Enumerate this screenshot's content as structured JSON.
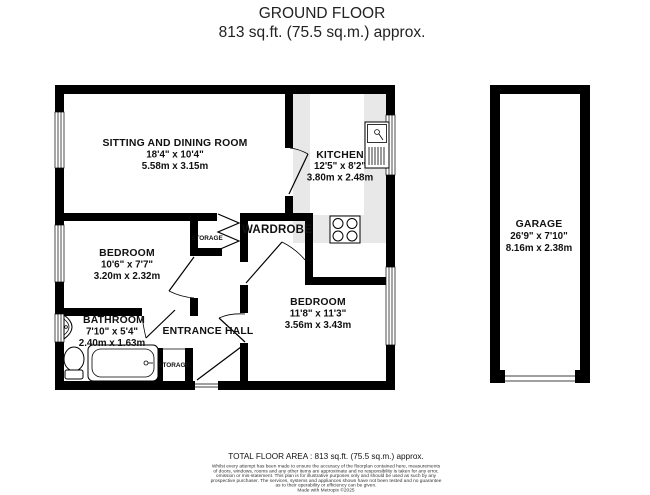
{
  "header": {
    "title": "GROUND FLOOR",
    "subtitle": "813 sq.ft. (75.5 sq.m.) approx."
  },
  "rooms": {
    "sitting_dining": {
      "name": "SITTING AND DINING ROOM",
      "imperial": "18'4\" x 10'4\"",
      "metric": "5.58m x 3.15m"
    },
    "kitchen": {
      "name": "KITCHEN",
      "imperial": "12'5\" x 8'2\"",
      "metric": "3.80m x 2.48m"
    },
    "bedroom1": {
      "name": "BEDROOM",
      "imperial": "10'6\" x 7'7\"",
      "metric": "3.20m x 2.32m"
    },
    "bedroom2": {
      "name": "BEDROOM",
      "imperial": "11'8\" x 11'3\"",
      "metric": "3.56m x 3.43m"
    },
    "bathroom": {
      "name": "BATHROOM",
      "imperial": "7'10\" x 5'4\"",
      "metric": "2.40m x 1.63m"
    },
    "garage": {
      "name": "GARAGE",
      "imperial": "26'9\" x 7'10\"",
      "metric": "8.16m x 2.38m"
    },
    "wardrobe": {
      "name": "WARDROBE"
    },
    "entrance_hall": {
      "name": "ENTRANCE HALL"
    },
    "storage_closet": {
      "name": "STORAGE"
    },
    "storage_hall": {
      "name": "STORAGE"
    }
  },
  "footer": {
    "total_area": "TOTAL FLOOR AREA : 813 sq.ft. (75.5 sq.m.) approx.",
    "disclaimer_lines": [
      "Whilst every attempt has been made to ensure the accuracy of the floorplan contained here, measurements",
      "of doors, windows, rooms and any other items are approximate and no responsibility is taken for any error,",
      "omission or mis-statement. This plan is for illustrative purposes only and should be used as such by any",
      "prospective purchaser. The services, systems and appliances shown have not been tested and no guarantee",
      "as to their operability or efficiency can be given."
    ],
    "credit": "Made with Metropix ©2025"
  },
  "colors": {
    "wall": "#000000",
    "counter": "#e8e8e8",
    "text": "#111111"
  }
}
